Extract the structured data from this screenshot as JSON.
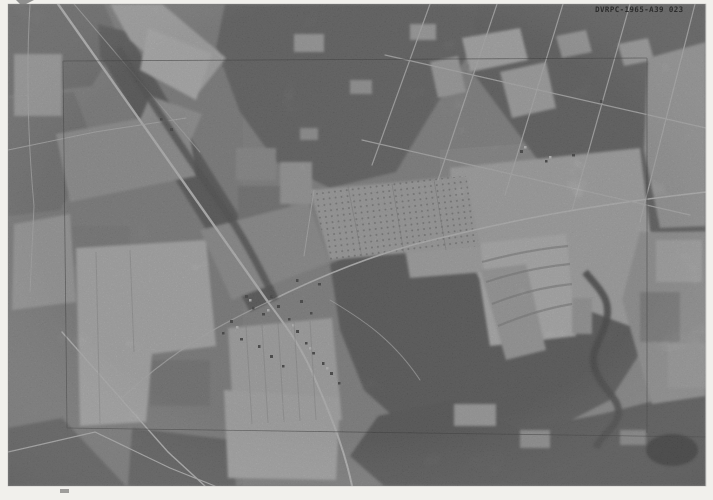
{
  "photo": {
    "stamp_label": "DVRPC-1965-A39 023"
  },
  "colors": {
    "margin": "#f1f0ec",
    "photo_base": "#959595",
    "woods_dark": "#666666",
    "field_light": "#c6c6c6",
    "road_light": "#dadada",
    "annotation_line": "#333333",
    "pond_dark": "#383838",
    "stamp_text": "#1e1e1e"
  }
}
